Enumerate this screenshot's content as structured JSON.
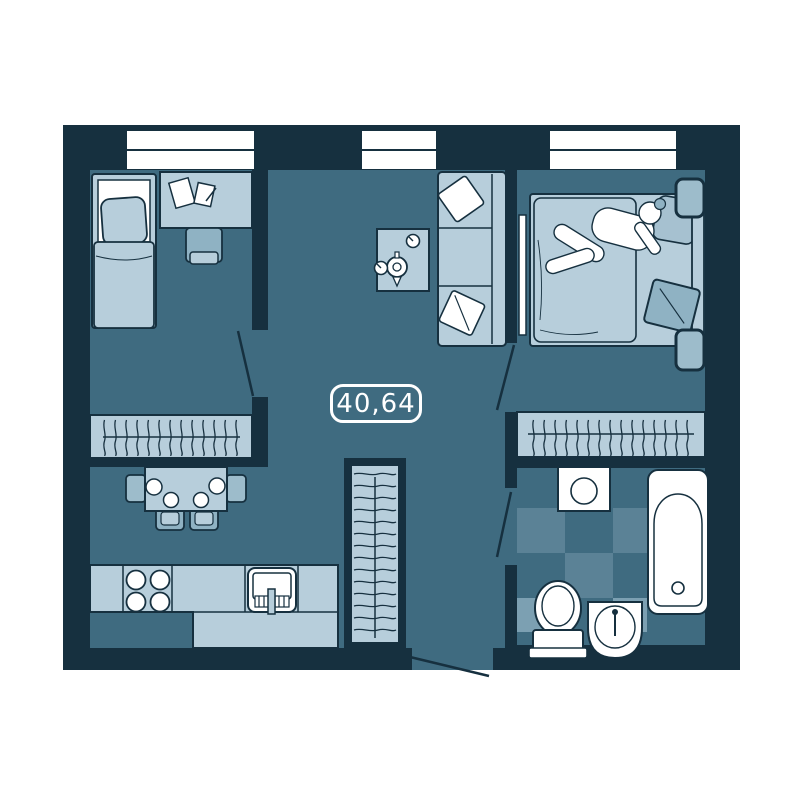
{
  "plan": {
    "area_label": "40,64"
  },
  "palette": {
    "wall": "#16303f",
    "floor": "#3f6b80",
    "furniture_light": "#b7cedb",
    "furniture_medium": "#8fb2c3",
    "tile_medium": "#5b8296",
    "tile_light": "#7ca0b2",
    "white": "#ffffff",
    "outside": "#ffffff"
  },
  "rooms": [
    {
      "name": "left-bedroom"
    },
    {
      "name": "living-room"
    },
    {
      "name": "kitchen-dining"
    },
    {
      "name": "hallway"
    },
    {
      "name": "main-bedroom"
    },
    {
      "name": "bathroom"
    }
  ],
  "furniture": [
    "single-bed",
    "desk",
    "desk-chair",
    "wardrobe-left",
    "dining-table",
    "dining-chairs",
    "kitchen-counter",
    "stove",
    "kitchen-sink",
    "hall-closet",
    "coffee-table",
    "teapot",
    "cups",
    "sofa",
    "sofa-pillows",
    "tv",
    "double-bed",
    "person",
    "nightstands",
    "bedroom-wardrobe",
    "washing-machine",
    "bathtub",
    "toilet",
    "bathroom-sink",
    "windows",
    "door-swings"
  ]
}
